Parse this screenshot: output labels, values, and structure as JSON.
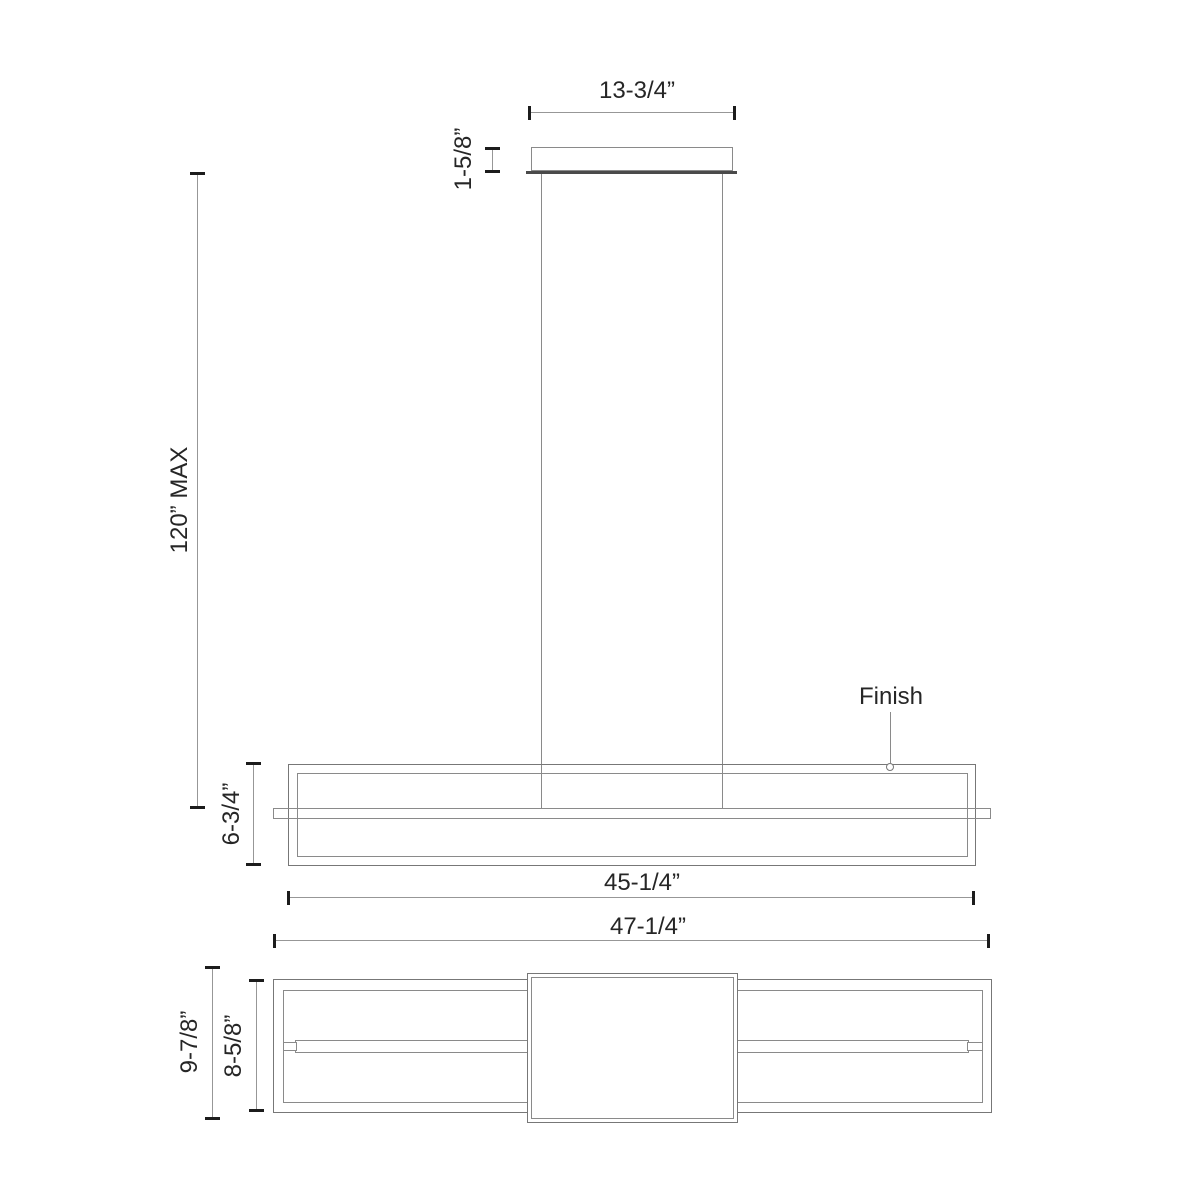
{
  "drawing": {
    "front_view": {
      "finish_label": "Finish"
    },
    "dimensions": {
      "canopy_width": "13-3/4”",
      "canopy_height": "1-5/8”",
      "suspension_max": "120” MAX",
      "fixture_height": "6-3/4”",
      "frame_length": "45-1/4”",
      "overall_length": "47-1/4”",
      "overall_depth": "9-7/8”",
      "frame_depth": "8-5/8”"
    },
    "colors": {
      "object_line": "#8a8a8a",
      "dimension_line": "#979797",
      "tick": "#1c1c1c",
      "text": "#262626",
      "background": "#ffffff"
    }
  }
}
